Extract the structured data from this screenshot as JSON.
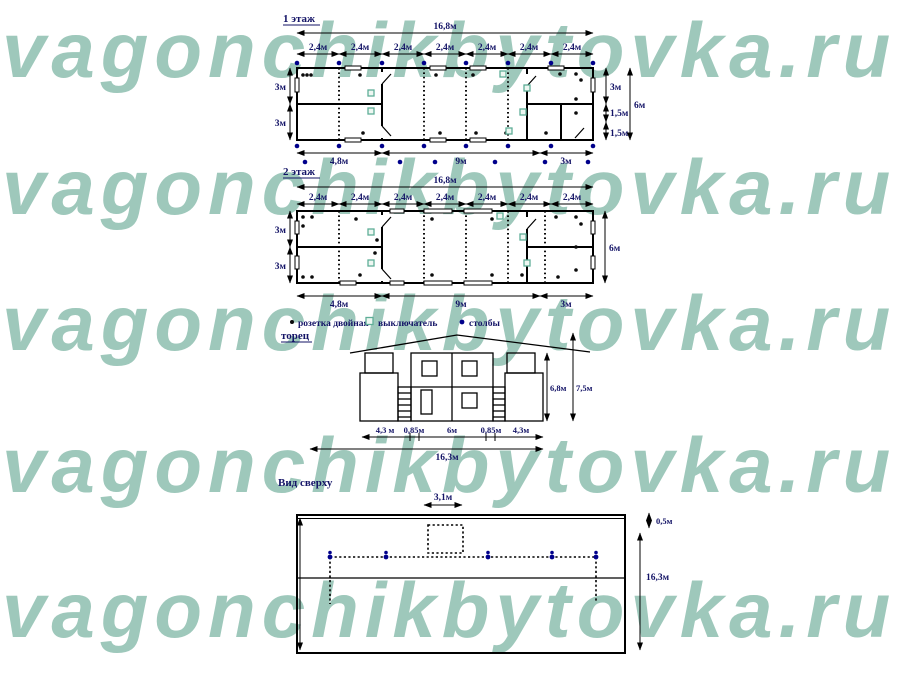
{
  "watermark": {
    "text": "vagonchikbytovka.ru",
    "color": "#9ec8bb"
  },
  "floor1": {
    "title": "1 этаж",
    "total": "16,8м",
    "segments": [
      "2,4м",
      "2,4м",
      "2,4м",
      "2,4м",
      "2,4м",
      "2,4м",
      "2,4м"
    ],
    "left": [
      "3м",
      "3м"
    ],
    "right_parts": [
      "3м",
      "1,5м",
      "1,5м"
    ],
    "right_total": "6м",
    "bottom": [
      "4,8м",
      "9м",
      "3м"
    ]
  },
  "floor2": {
    "title": "2 этаж",
    "total": "16,8м",
    "segments": [
      "2,4м",
      "2,4м",
      "2,4м",
      "2,4м",
      "2,4м",
      "2,4м",
      "2,4м"
    ],
    "left": [
      "3м",
      "3м"
    ],
    "right_total": "6м",
    "bottom": [
      "4,8м",
      "9м",
      "3м"
    ]
  },
  "legend": {
    "socket": "розетка двойная",
    "switch": "выключатель",
    "posts": "столбы"
  },
  "elevation": {
    "title": "торец",
    "h_wall": "6,8м",
    "h_total": "7,5м",
    "bottom": [
      "4,3 м",
      "0,85м",
      "6м",
      "0,85м",
      "4,3м"
    ],
    "total": "16,3м"
  },
  "topview": {
    "title": "Вид сверху",
    "top_dim": "3,1м",
    "offset_dim": "0,5м",
    "length_dim": "16,3м"
  },
  "colors": {
    "watermark": "#9ec8bb",
    "label": "#131366",
    "post": "#00008b",
    "switch_outline": "#5fae97",
    "line": "#000000"
  }
}
